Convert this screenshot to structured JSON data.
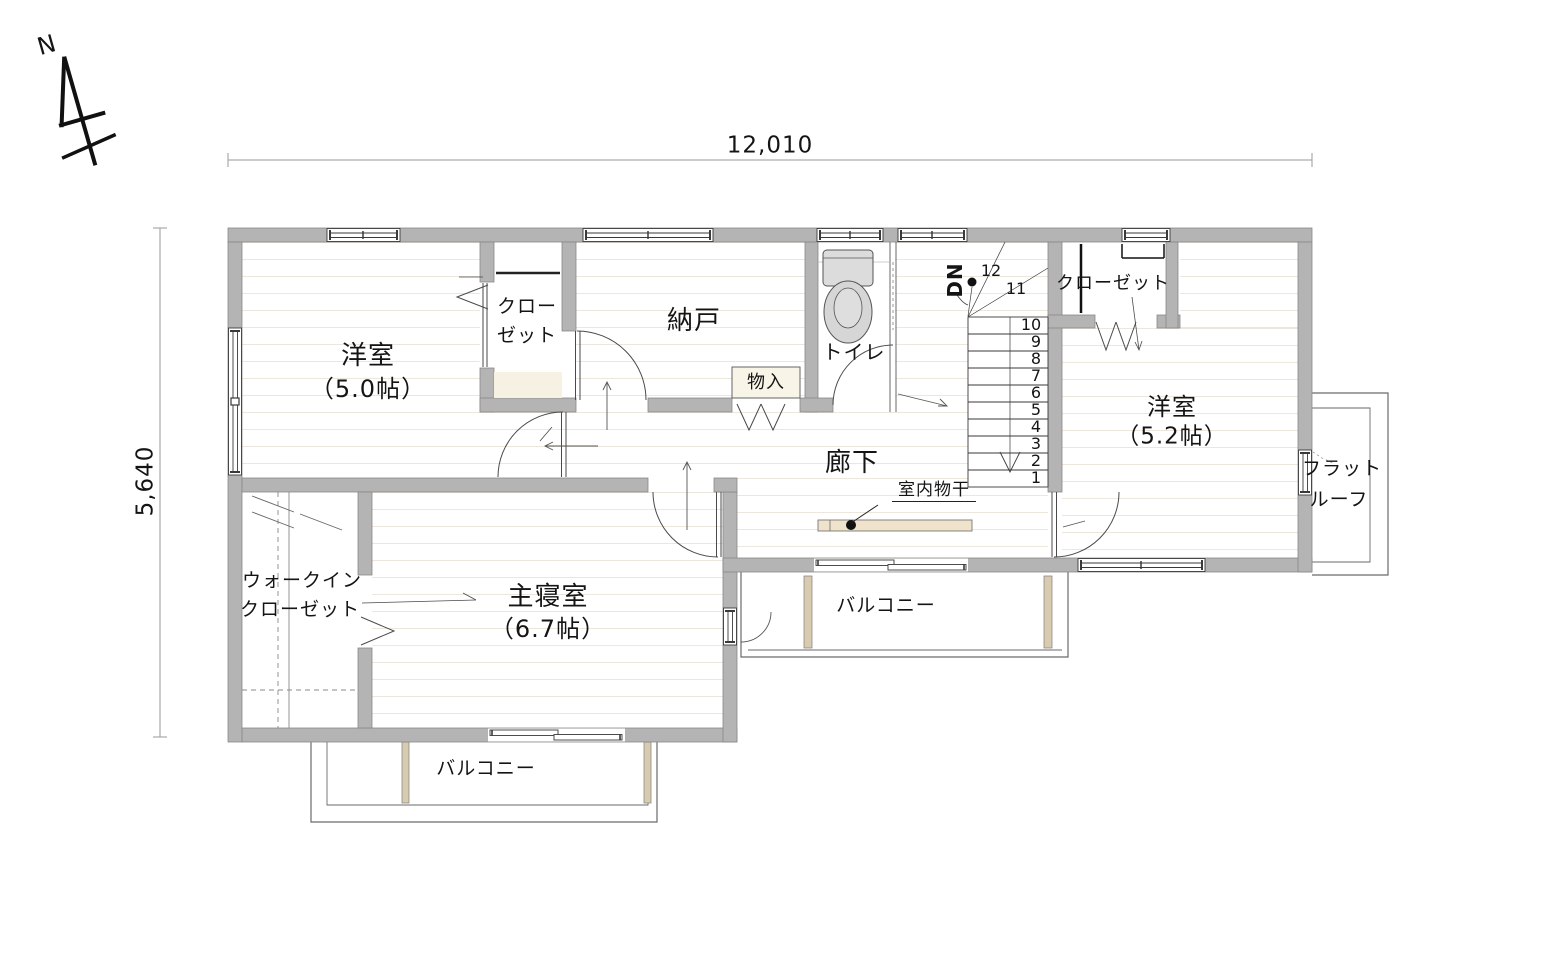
{
  "compass": {
    "label": "N"
  },
  "dimensions": {
    "top": "12,010",
    "left": "5,640"
  },
  "rooms": {
    "western_room_1": {
      "name": "洋室",
      "size": "（5.0帖）"
    },
    "closet_left": {
      "line1": "クロー",
      "line2": "ゼット"
    },
    "storage_room": {
      "name": "納戸"
    },
    "storage_small": {
      "name": "物入"
    },
    "toilet": {
      "name": "トイレ"
    },
    "hallway": {
      "name": "廊下"
    },
    "closet_right": {
      "name": "クローゼット"
    },
    "western_room_2": {
      "name": "洋室",
      "size": "（5.2帖）"
    },
    "flat_roof": {
      "line1": "フラット",
      "line2": "ルーフ"
    },
    "walk_in_closet": {
      "line1": "ウォークイン",
      "line2": "クローゼット"
    },
    "master_bedroom": {
      "name": "主寝室",
      "size": "（6.7帖）"
    },
    "balcony_middle": {
      "name": "バルコニー"
    },
    "balcony_bottom": {
      "name": "バルコニー"
    }
  },
  "annotations": {
    "indoor_laundry": "室内物干",
    "stairs_down": "DN"
  },
  "stairs": {
    "numbers": [
      "12",
      "11",
      "10",
      "9",
      "8",
      "7",
      "6",
      "5",
      "4",
      "3",
      "2",
      "1"
    ]
  },
  "colors": {
    "wall": "#b4b4b4",
    "fixture": "#d9d9d9",
    "wood_bar": "#efe3cb",
    "line": "#3a3a3a"
  }
}
